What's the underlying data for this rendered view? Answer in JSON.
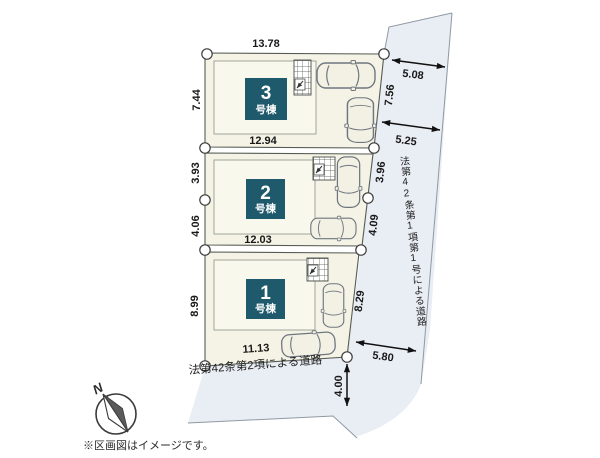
{
  "note": "※区画図はイメージです。",
  "compass": {
    "north_label": "N"
  },
  "roads": {
    "east_label": "法第42条第1項第1号による道路",
    "south_label": "法第42条第2項による道路",
    "east_width_top": "5.08",
    "east_width_mid": "5.25",
    "east_width_bottom": "5.80",
    "south_width": "4.00"
  },
  "lots": [
    {
      "number": "3",
      "name_suffix": "号棟",
      "dim_top": "13.78",
      "dim_bottom": "12.94",
      "dim_left": "7.44",
      "dim_right": "7.56"
    },
    {
      "number": "2",
      "name_suffix": "号棟",
      "dim_bottom": "12.03",
      "dim_left_top": "3.93",
      "dim_left_bottom": "4.06",
      "dim_right_top": "3.96",
      "dim_right_bottom": "4.09"
    },
    {
      "number": "1",
      "name_suffix": "号棟",
      "dim_bottom": "11.13",
      "dim_left": "8.99",
      "dim_right": "8.29"
    }
  ],
  "colors": {
    "road_fill": "#e9edf4",
    "lot_fill": "#f4f3e5",
    "building_fill": "#f9f8ec",
    "accent_teal": "#1e5a6c"
  }
}
